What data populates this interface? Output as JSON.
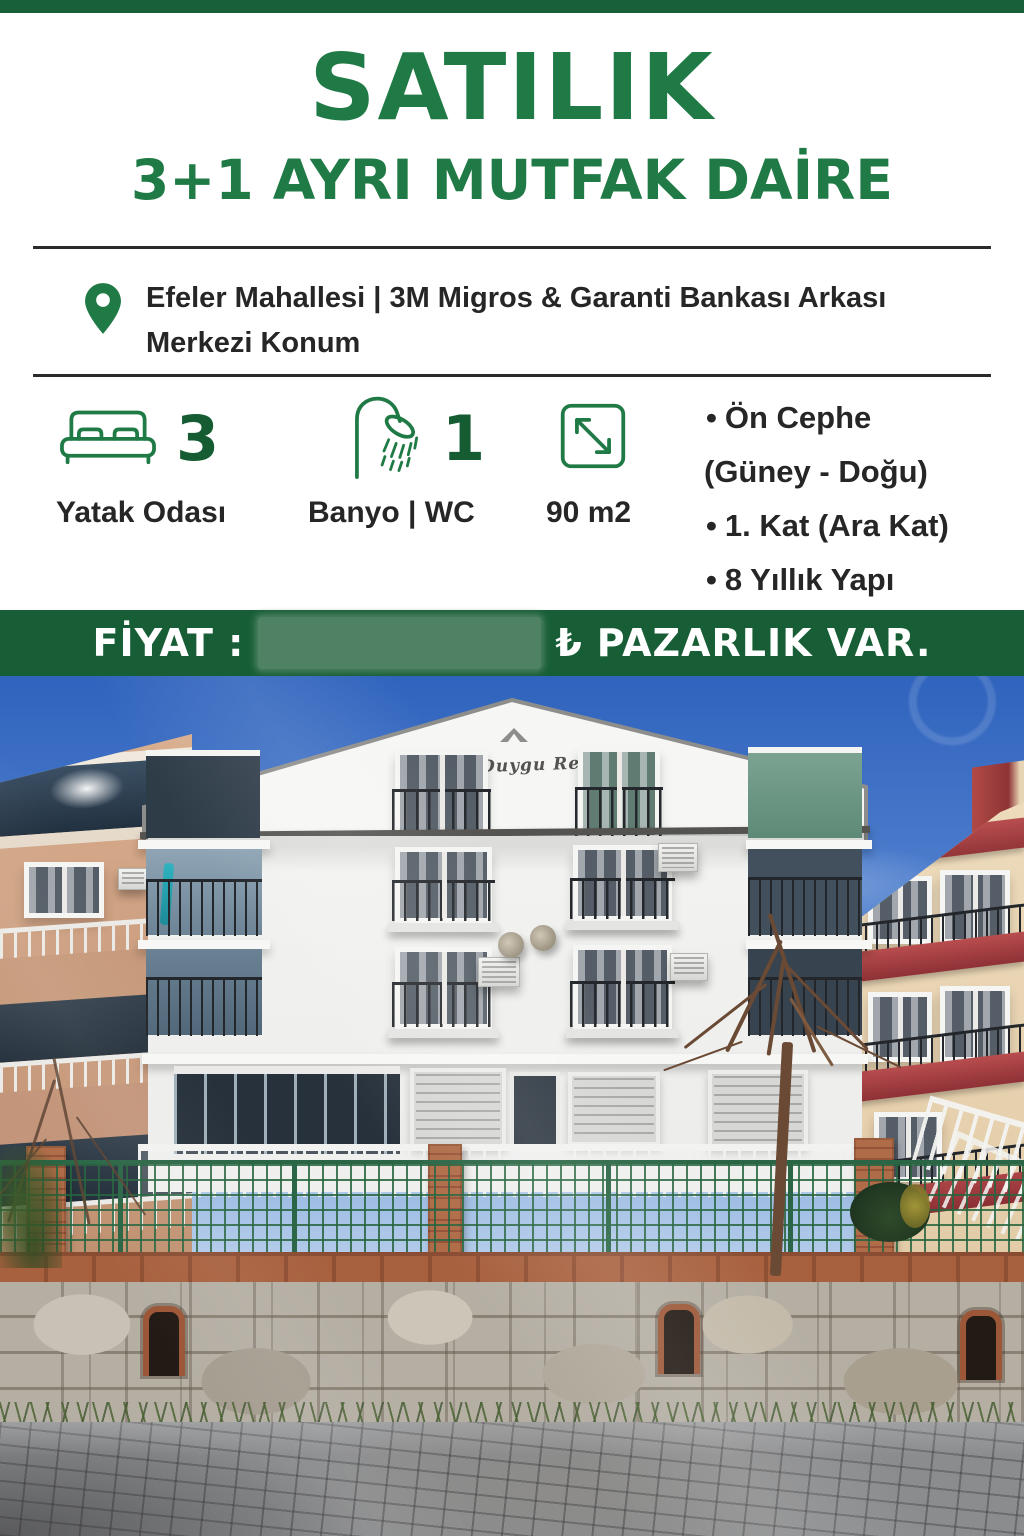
{
  "colors": {
    "brand_green": "#1f7a45",
    "band_green": "#175e36",
    "number_green": "#155c33",
    "blur_box_green": "#4f8264",
    "text_dark": "#262626"
  },
  "poster": {
    "title": "SATILIK",
    "subtitle": "3+1 AYRI MUTFAK DAİRE",
    "location": {
      "line1": "Efeler Mahallesi | 3M Migros & Garanti Bankası Arkası",
      "line2": "Merkezi Konum"
    },
    "features": [
      {
        "icon": "bed-icon",
        "value": "3",
        "label": "Yatak Odası"
      },
      {
        "icon": "shower-icon",
        "value": "1",
        "label": "Banyo | WC"
      },
      {
        "icon": "area-icon",
        "value": "",
        "label": "90 m2"
      }
    ],
    "bullet_char": "•",
    "details": [
      {
        "bullet": true,
        "text": "Ön Cephe"
      },
      {
        "bullet": false,
        "text": "(Güney - Doğu)"
      },
      {
        "bullet": true,
        "text": "1. Kat (Ara Kat)"
      },
      {
        "bullet": true,
        "text": "8 Yıllık Yapı"
      }
    ],
    "price": {
      "label": "FİYAT :",
      "currency": "₺",
      "note": "PAZARLIK VAR."
    },
    "photo": {
      "building_sign": "Duygu Residence"
    }
  }
}
